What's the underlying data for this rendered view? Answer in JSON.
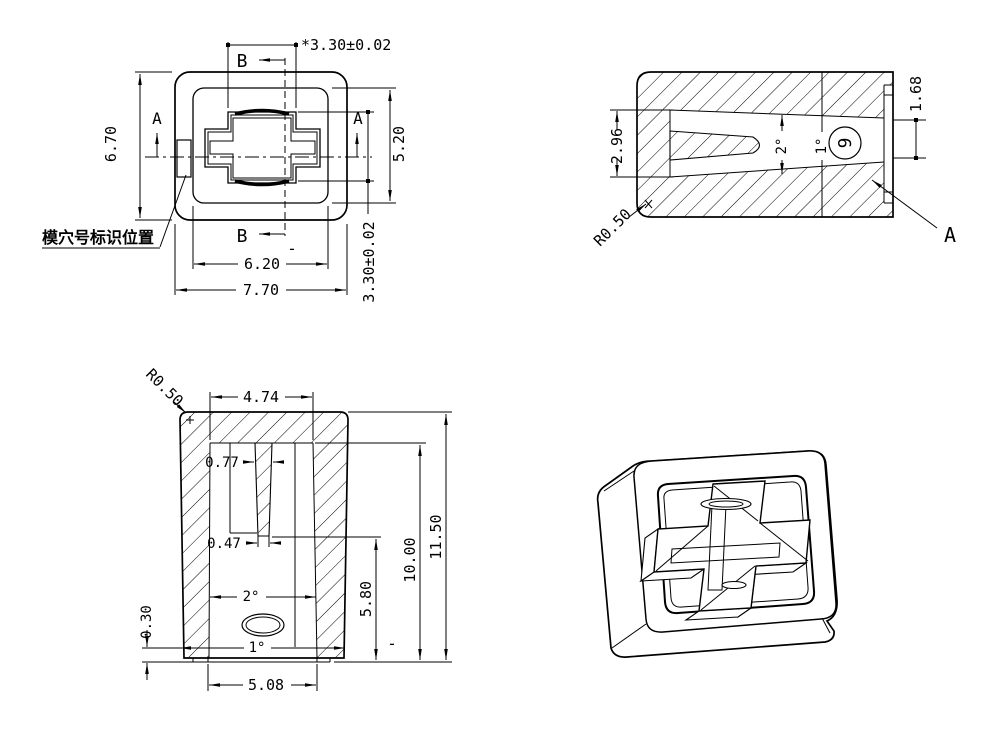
{
  "drawing": {
    "plan_view": {
      "section_b_label": "B",
      "section_a_label": "A",
      "note_mold_cavity": "模穴号标识位置",
      "dims": {
        "stem_slot_width": "*3.30±0.02",
        "body_height": "6.70",
        "recess_height": "5.20",
        "stem_slot_height": "3.30±0.02",
        "recess_width": "6.20",
        "body_width": "7.70",
        "tick": "-"
      }
    },
    "section_a_view": {
      "view_label": "A",
      "cavity_number": "9",
      "dims": {
        "slot_height_left": "2.96",
        "slot_height_right": "1.68",
        "draft_inner": "2°",
        "draft_outer": "1°",
        "corner_radius": "R0.50"
      }
    },
    "section_b_view": {
      "dims": {
        "corner_radius": "R0.50",
        "cavity_top_width": "4.74",
        "rib_width_top": "0.77",
        "rib_width_bottom": "0.47",
        "draft_inner": "2°",
        "draft_outer": "1°",
        "lip_height": "0.30",
        "bottom_opening": "5.08",
        "height_mid": "5.80",
        "height_cavity": "10.00",
        "height_total": "11.50",
        "tick": "-"
      }
    }
  }
}
